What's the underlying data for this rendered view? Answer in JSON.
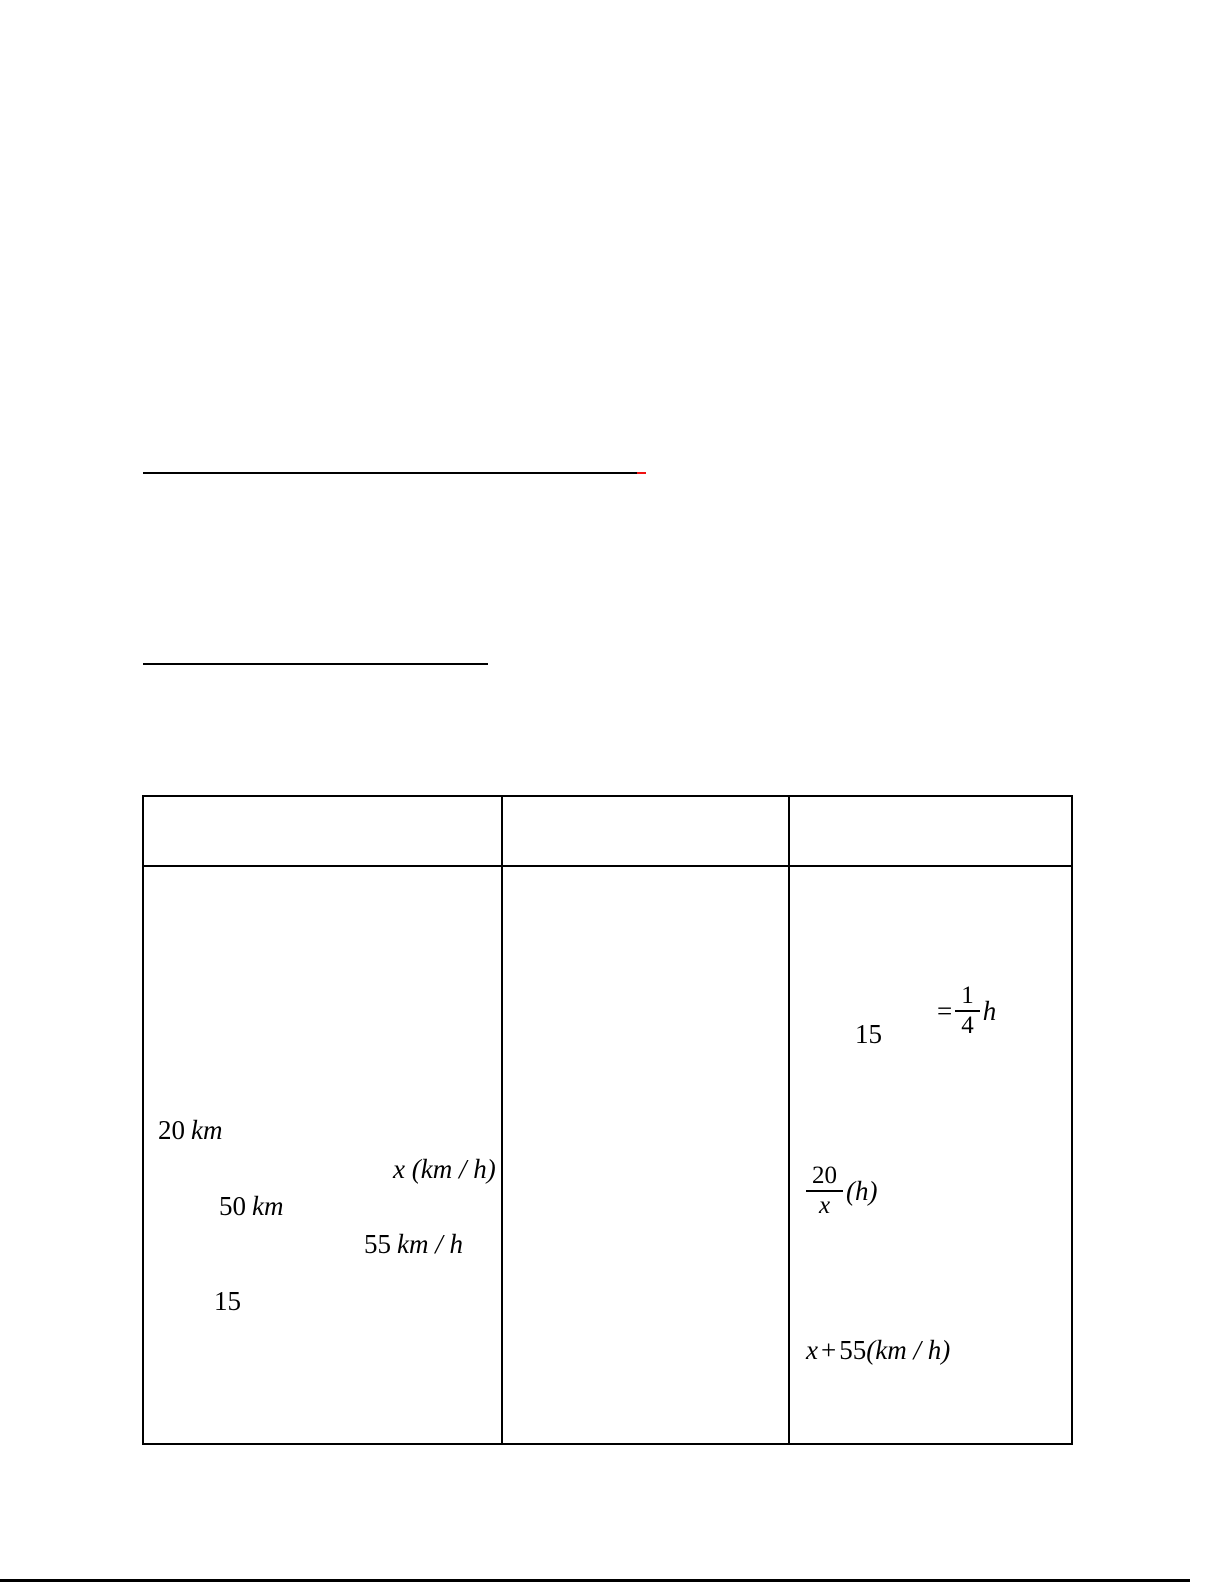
{
  "document": {
    "background_color": "#ffffff",
    "ink_color": "#000000"
  },
  "answer_blanks": {
    "line1": {
      "main_color": "#000000",
      "tip_color": "#ee1111"
    },
    "line2": {
      "color": "#000000"
    }
  },
  "worksheet_table": {
    "border_color": "#000000",
    "header_row": {
      "col1": "",
      "col2": "",
      "col3": ""
    },
    "body_row": {
      "col1": {
        "expr_20km": {
          "num": "20",
          "unit": "km"
        },
        "expr_x_speed": "x (km / h)",
        "expr_50km": {
          "num": "50",
          "unit": "km"
        },
        "expr_55kmh": {
          "num": "55",
          "unit": "km / h"
        },
        "expr_15": "15"
      },
      "col3": {
        "expr_quarter_hour": {
          "lead": "15",
          "equals": "=",
          "numerator": "1",
          "denominator": "4",
          "suffix": "h"
        },
        "expr_20_over_x": {
          "numerator": "20",
          "denominator": "x",
          "suffix": "(h)"
        },
        "expr_x_plus_55": {
          "var": "x",
          "operator": "+",
          "coefficient": "55",
          "unit": "(km / h)"
        }
      }
    }
  },
  "footer_rule": {
    "color": "#000000"
  }
}
